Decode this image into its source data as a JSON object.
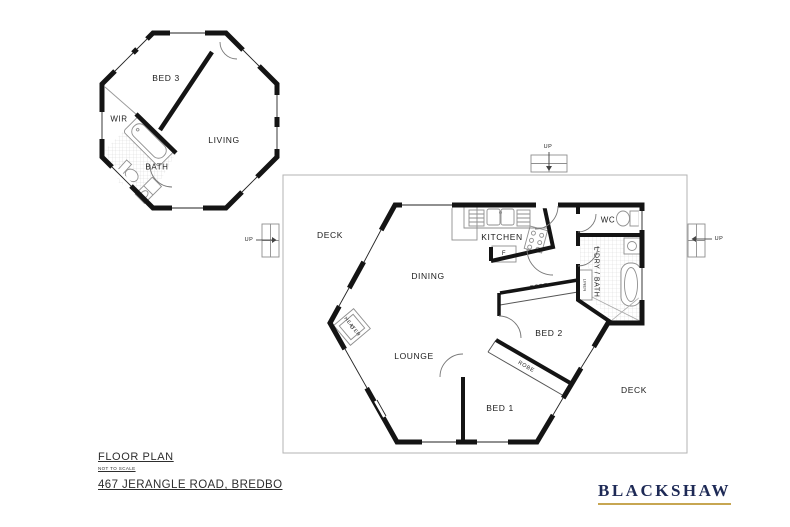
{
  "page": {
    "background_color": "#ffffff"
  },
  "octagon_unit": {
    "rooms": {
      "bed3": "BED 3",
      "wir": "WIR",
      "bath": "BATH",
      "living": "LIVING"
    }
  },
  "main_unit": {
    "rooms": {
      "deck_left": "DECK",
      "deck_right": "DECK",
      "kitchen": "KITCHEN",
      "dining": "DINING",
      "lounge": "LOUNGE",
      "bed1": "BED 1",
      "bed2": "BED 2",
      "wc": "WC",
      "laundry_bath": "L'DRY / BATH",
      "linen": "LINEN",
      "robe_upper": "ROBE",
      "robe_lower": "ROBE",
      "heater": "HEATER",
      "fridge": "F"
    },
    "stairs": {
      "up_top": "UP",
      "up_left": "UP",
      "up_right": "UP"
    }
  },
  "title_block": {
    "title": "FLOOR PLAN",
    "scale_note": "NOT TO SCALE",
    "address": "467 JERANGLE ROAD, BREDBO"
  },
  "branding": {
    "name": "BLACKSHAW",
    "text_color": "#1e2a56",
    "underline_color": "#c7a652"
  }
}
